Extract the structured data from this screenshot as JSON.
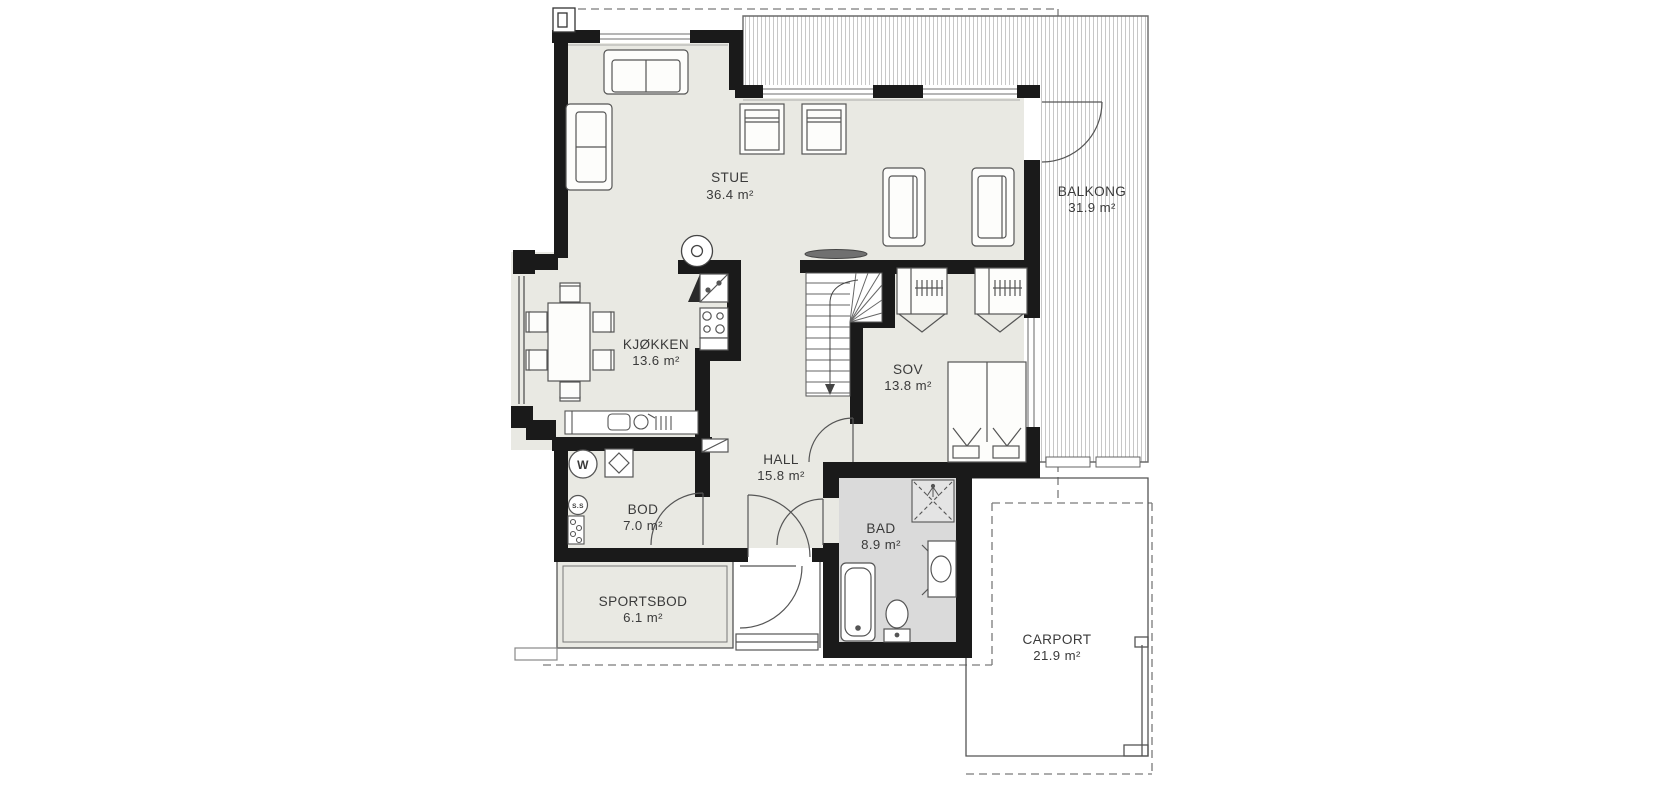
{
  "rooms": {
    "stue": {
      "name": "STUE",
      "area": "36.4 m²"
    },
    "balkong": {
      "name": "BALKONG",
      "area": "31.9 m²"
    },
    "kjokken": {
      "name": "KJØKKEN",
      "area": "13.6 m²"
    },
    "sov": {
      "name": "SOV",
      "area": "13.8 m²"
    },
    "hall": {
      "name": "HALL",
      "area": "15.8 m²"
    },
    "bod": {
      "name": "BOD",
      "area": "7.0 m²"
    },
    "bad": {
      "name": "BAD",
      "area": "8.9 m²"
    },
    "sportsbod": {
      "name": "SPORTSBOD",
      "area": "6.1 m²"
    },
    "carport": {
      "name": "CARPORT",
      "area": "21.9 m²"
    }
  },
  "appliances": {
    "washing_machine": "W",
    "water_heater": "S.S"
  },
  "colors": {
    "wall": "#1a1a1a",
    "floor": "#e9e9e3",
    "bath_floor": "#dadada",
    "hatch_line": "#c7c7c7",
    "outline": "#555555",
    "text": "#3a3a3a"
  }
}
